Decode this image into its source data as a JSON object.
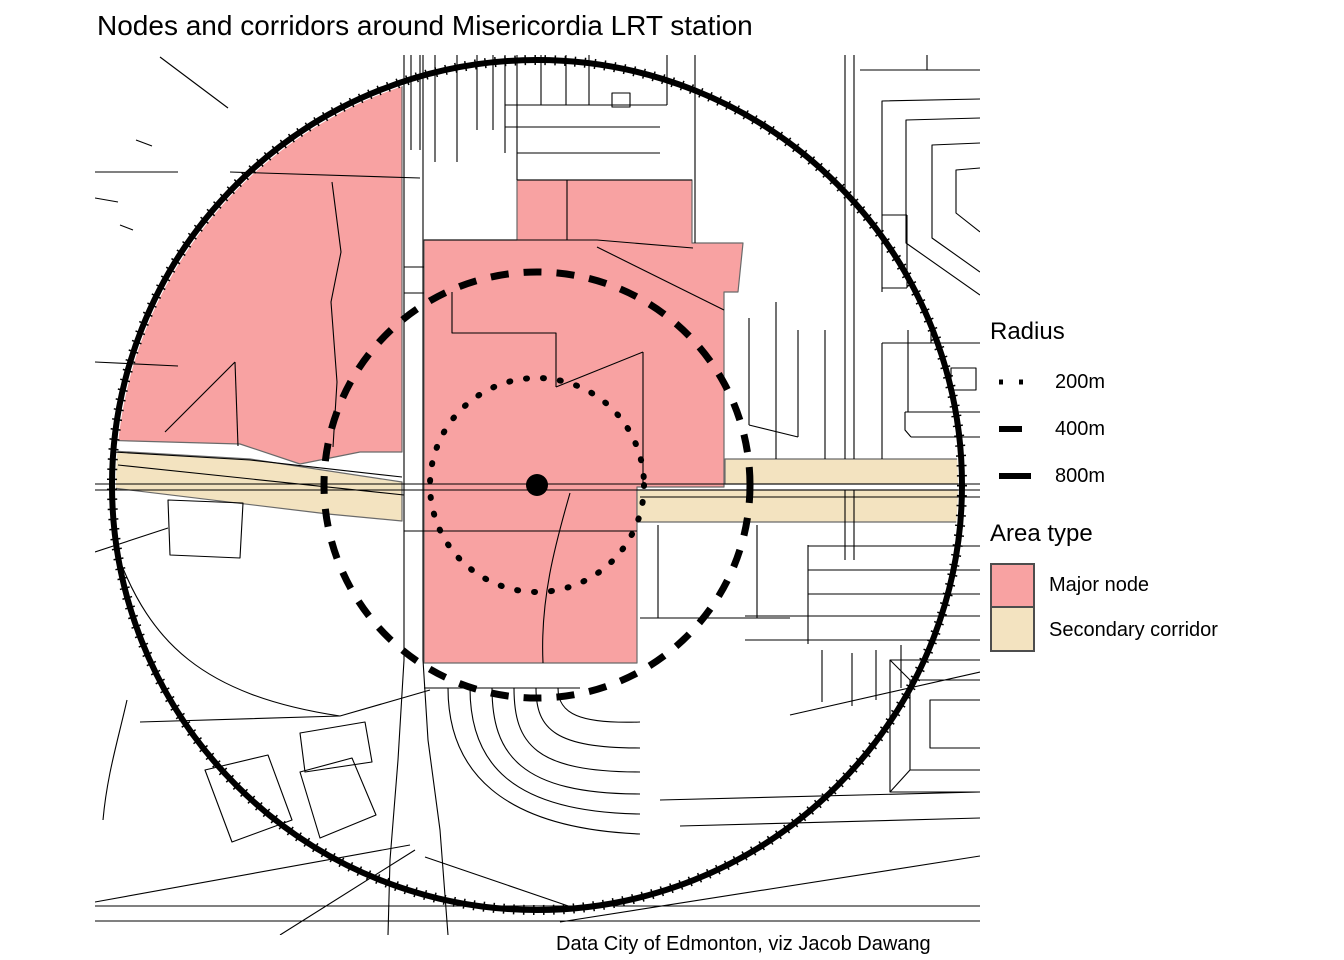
{
  "title": "Nodes and corridors around Misericordia LRT station",
  "caption": "Data City of Edmonton, viz Jacob Dawang",
  "legend": {
    "radius": {
      "heading": "Radius",
      "items": [
        {
          "label": "200m",
          "line_style": "dotted"
        },
        {
          "label": "400m",
          "line_style": "dashed"
        },
        {
          "label": "800m",
          "line_style": "solid"
        }
      ]
    },
    "area_type": {
      "heading": "Area type",
      "items": [
        {
          "label": "Major node",
          "color": "#F8A2A2"
        },
        {
          "label": "Secondary corridor",
          "color": "#F3E3C0"
        }
      ]
    }
  },
  "map_data": {
    "type": "map",
    "subject": "walking radii around an LRT station",
    "station_marker": "filled black dot at map centre",
    "radius_rings_m": [
      200,
      400,
      800
    ],
    "ring_styles": {
      "200m": "dotted",
      "400m": "dashed",
      "800m": "solid"
    },
    "area_types": [
      {
        "name": "Major node",
        "color": "#F8A2A2"
      },
      {
        "name": "Secondary corridor",
        "color": "#F3E3C0"
      }
    ],
    "colors": {
      "major_node": "#F8A2A2",
      "secondary_corridor": "#F3E3C0",
      "parcel_line": "#000000",
      "ring": "#000000",
      "background": "#FFFFFF"
    }
  }
}
